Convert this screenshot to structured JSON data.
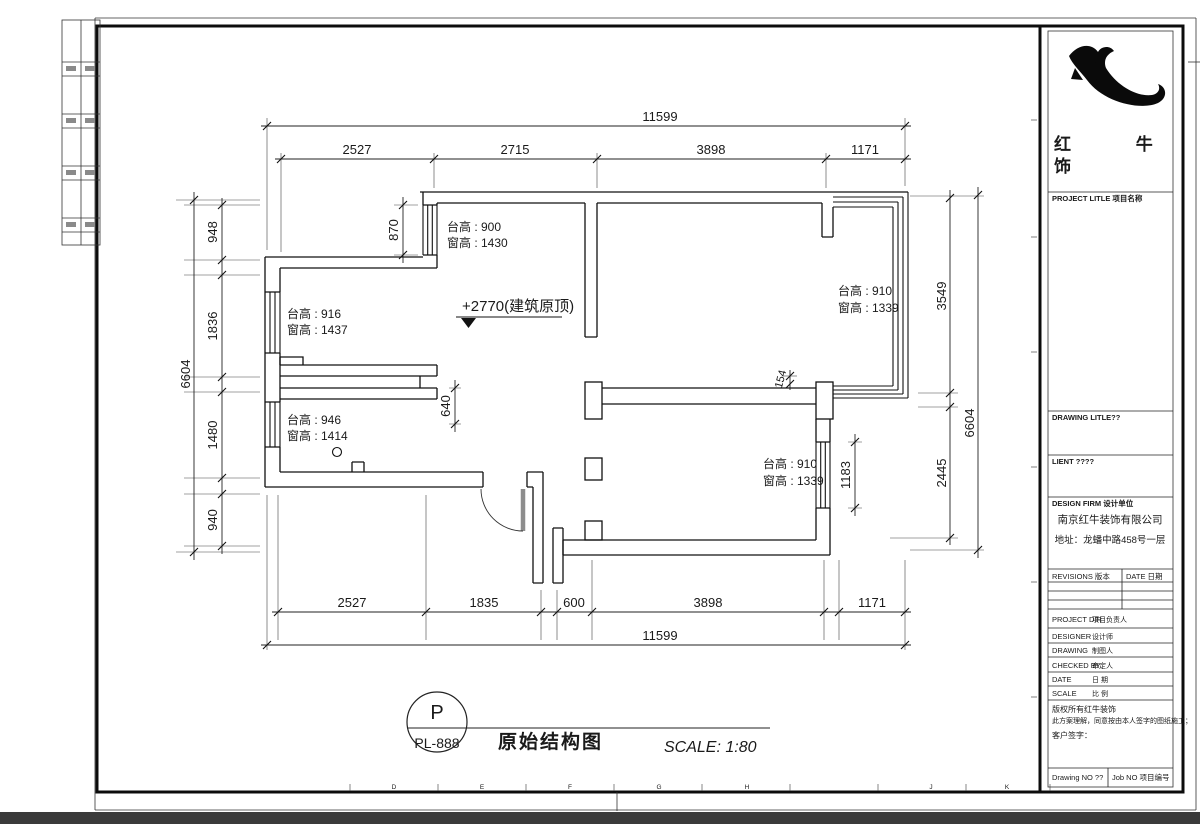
{
  "sheet": {
    "grid_letters": [
      "D",
      "E",
      "F",
      "G",
      "H",
      "J",
      "K"
    ],
    "stamp": {
      "letter": "P",
      "code": "PL-888",
      "title": "原始结构图",
      "scale": "SCALE: 1:80"
    }
  },
  "plan": {
    "elevation_note": "+2770(建筑原顶)",
    "dims": {
      "top": {
        "overall": "11599",
        "segments": [
          "2527",
          "2715",
          "3898",
          "1171"
        ]
      },
      "bottom": {
        "overall": "11599",
        "segments": [
          "2527",
          "1835",
          "600",
          "3898",
          "1171"
        ]
      },
      "left": {
        "overall": "6604",
        "segments": [
          "948",
          "1836",
          "1480",
          "940"
        ]
      },
      "right": {
        "overall": "6604",
        "segments": [
          "3549",
          "2445"
        ]
      },
      "interior": {
        "kitchen_window": "870",
        "hallway": "640",
        "wall_offset": "154",
        "bedroom_window": "1183"
      }
    },
    "window_notes": [
      {
        "line1": "台高 : 900",
        "line2": "窗高 : 1430"
      },
      {
        "line1": "台高 : 916",
        "line2": "窗高 : 1437"
      },
      {
        "line1": "台高 : 946",
        "line2": "窗高 : 1414"
      },
      {
        "line1": "台高 : 910",
        "line2": "窗高 : 1339"
      },
      {
        "line1": "台高 : 910",
        "line2": "窗高 : 1339"
      }
    ]
  },
  "titleblock": {
    "brand_line1": "红 牛 装",
    "brand_line2": "饰",
    "project_title_label": "PROJECT LITLE 项目名称",
    "drawing_title_label": "DRAWING LITLE??",
    "client_label": "LIENT ????",
    "design_firm_label": "DESIGN FIRM 设计单位",
    "company_name": "南京红牛装饰有限公司",
    "company_address": "地址：龙蟠中路458号一层",
    "revisions_label": "REVISIONS 版本",
    "revisions_date_label": "DATE 日期",
    "rows": [
      {
        "en": "PROJECT DIR",
        "zh": "项目负责人"
      },
      {
        "en": "DESIGNER",
        "zh": "设计师"
      },
      {
        "en": "DRAWING",
        "zh": "制图人"
      },
      {
        "en": "CHECKED BY",
        "zh": "审定人"
      },
      {
        "en": "DATE",
        "zh": "日 期"
      },
      {
        "en": "SCALE",
        "zh": "比 例"
      }
    ],
    "copyright_lines": [
      "版权所有红牛装饰",
      "此方案理解，同意按由本人签字的图纸施工；",
      "客户签字："
    ],
    "drawing_no_label": "Drawing NO ??",
    "job_no_label": "Job NO 项目编号"
  }
}
